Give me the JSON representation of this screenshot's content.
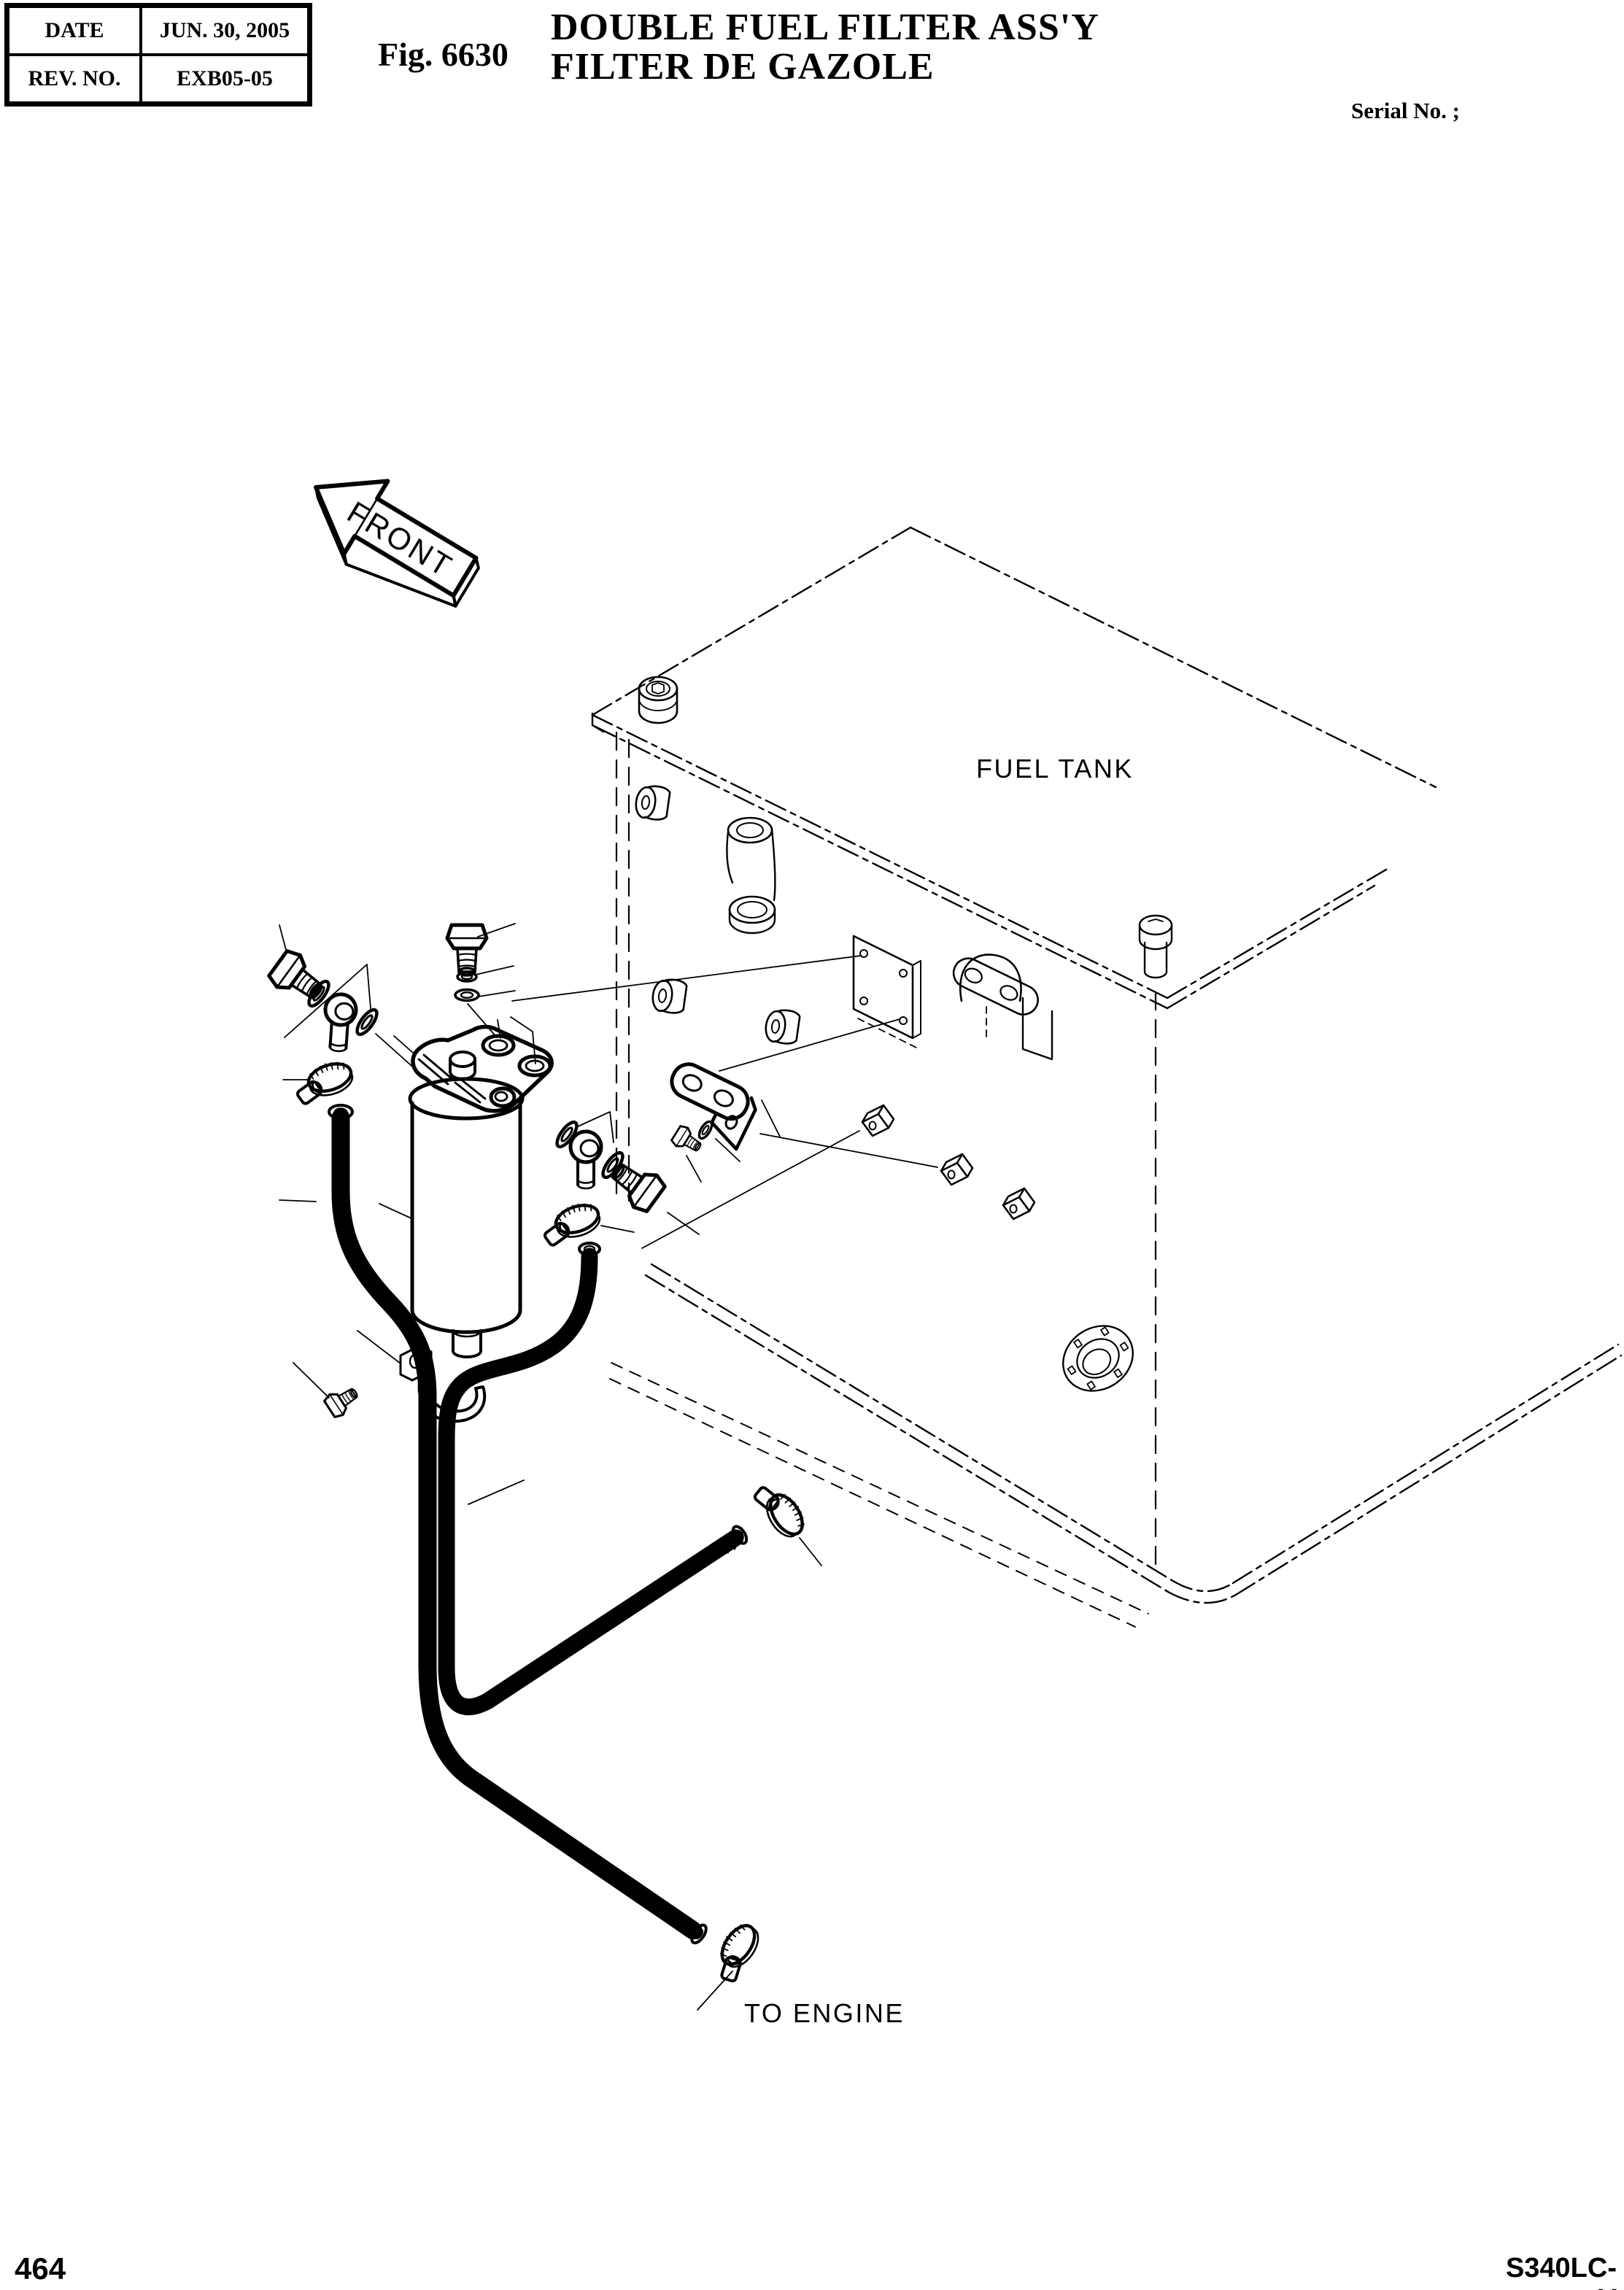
{
  "page": {
    "background": "#ffffff",
    "line_color": "#000000"
  },
  "header": {
    "table": {
      "rows": [
        {
          "label": "DATE",
          "value": "JUN. 30, 2005"
        },
        {
          "label": "REV. NO.",
          "value": "EXB05-05"
        }
      ]
    },
    "fig_label": "Fig. 6630",
    "title_line1": "DOUBLE FUEL FILTER ASS'Y",
    "title_line2": "FILTER DE GAZOLE",
    "serial_label": "Serial No. ;"
  },
  "diagram": {
    "labels": {
      "front": "FRONT",
      "fuel_tank": "FUEL TANK",
      "to_engine": "TO ENGINE"
    }
  },
  "footer": {
    "page_number": "464",
    "model_code": "S340LC-V"
  }
}
